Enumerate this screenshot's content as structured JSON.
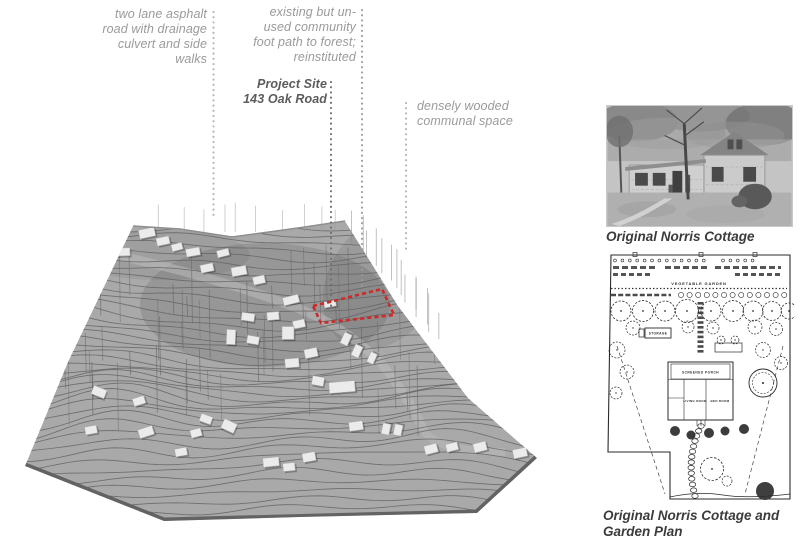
{
  "figure": {
    "annotations": {
      "road": {
        "lines": [
          "two lane asphalt",
          "road with drainage",
          "culvert and side",
          "walks"
        ]
      },
      "footpath": {
        "lines": [
          "existing but un-",
          "used community",
          "foot path to forest;",
          "reinstituted"
        ]
      },
      "project_site": {
        "lines": [
          "Project Site",
          "143 Oak Road"
        ]
      },
      "woods": {
        "lines": [
          "densely wooded",
          "communal space"
        ]
      }
    }
  },
  "sidebar": {
    "photo_caption": "Original Norris Cottage",
    "plan_caption": "Original Norris Cottage and Garden Plan",
    "plan_labels": {
      "vegetable_garden": "VEGETABLE GARDEN",
      "storage": "STORAGE",
      "screened_porch": "SCREENED PORCH",
      "living_room": "LIVING ROOM",
      "bed_room": "BED ROOM"
    }
  },
  "colors": {
    "annotation_text": "#9a9a9a",
    "annotation_strong": "#5c5c5c",
    "caption_text": "#3b3b3b",
    "site_outline_red": "#cd2a2a",
    "terrain_base": "#a9a9a9",
    "contour_line": "#5f5f5f",
    "leader_light": "#b3b3b3",
    "leader_mid": "#9c9c9c",
    "leader_dark": "#6e6e6e"
  }
}
